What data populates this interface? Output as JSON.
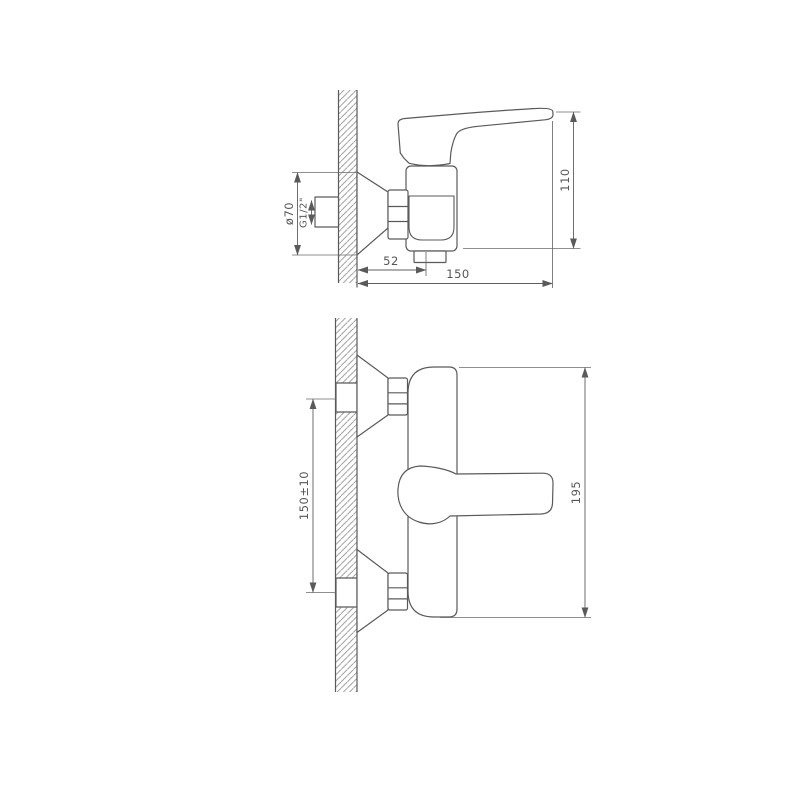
{
  "labels": {
    "side_view": {
      "flange_diameter": "ø70",
      "thread": "G1/2\"",
      "spout_offset": "52",
      "projection": "150",
      "height": "110"
    },
    "front_view": {
      "connection_spacing": "150±10",
      "overall_width": "195"
    }
  },
  "colors": {
    "background": "#ffffff",
    "line": "#5a5a5a",
    "hatch": "#8f8f8f",
    "text": "#565656"
  }
}
